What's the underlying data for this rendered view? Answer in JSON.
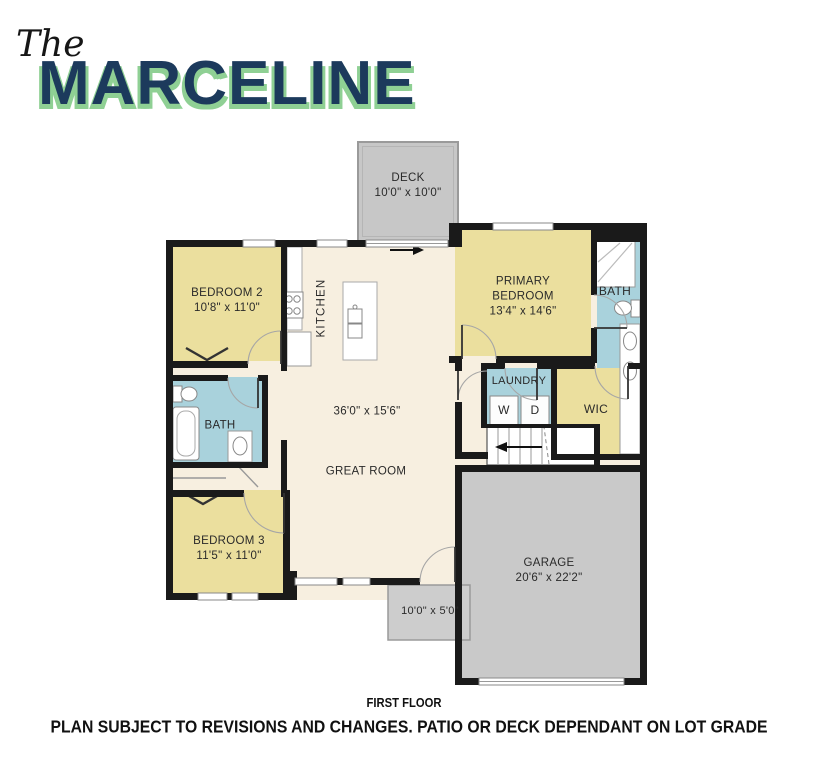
{
  "title": {
    "script_prefix": "The",
    "name": "MARCELINE"
  },
  "rooms": {
    "deck": {
      "label": "DECK",
      "dims": "10'0\" x 10'0\""
    },
    "bedroom2": {
      "label": "BEDROOM 2",
      "dims": "10'8\" x 11'0\""
    },
    "kitchen": {
      "label": "KITCHEN"
    },
    "primary_bedroom": {
      "label": "PRIMARY BEDROOM",
      "dims": "13'4\" x 14'6\""
    },
    "primary_bath": {
      "label": "BATH"
    },
    "laundry": {
      "label": "LAUNDRY",
      "washer_label": "W",
      "dryer_label": "D"
    },
    "wic": {
      "label": "WIC"
    },
    "great_room": {
      "label": "GREAT ROOM",
      "dims": "36'0\" x 15'6\""
    },
    "hall_bath": {
      "label": "BATH"
    },
    "bedroom3": {
      "label": "BEDROOM 3",
      "dims": "11'5\" x 11'0\""
    },
    "garage": {
      "label": "GARAGE",
      "dims": "20'6\" x 22'2\""
    },
    "patio": {
      "dims": "10'0\" x 5'0\""
    }
  },
  "footer": {
    "floor_label": "FIRST FLOOR",
    "disclaimer": "PLAN SUBJECT TO REVISIONS AND CHANGES. PATIO OR DECK DEPENDANT ON LOT GRADE"
  },
  "colors": {
    "title_navy": "#1c3a5c",
    "title_green": "#8fd094",
    "room_yellow": "#ebdf9e",
    "room_cream": "#f7efe0",
    "room_blue": "#a9d2dc",
    "deck_gray": "#c7c7c7",
    "garage_gray": "#c9c9c9",
    "patio_gray": "#cdcdcd",
    "wall_black": "#1a1a1a"
  }
}
